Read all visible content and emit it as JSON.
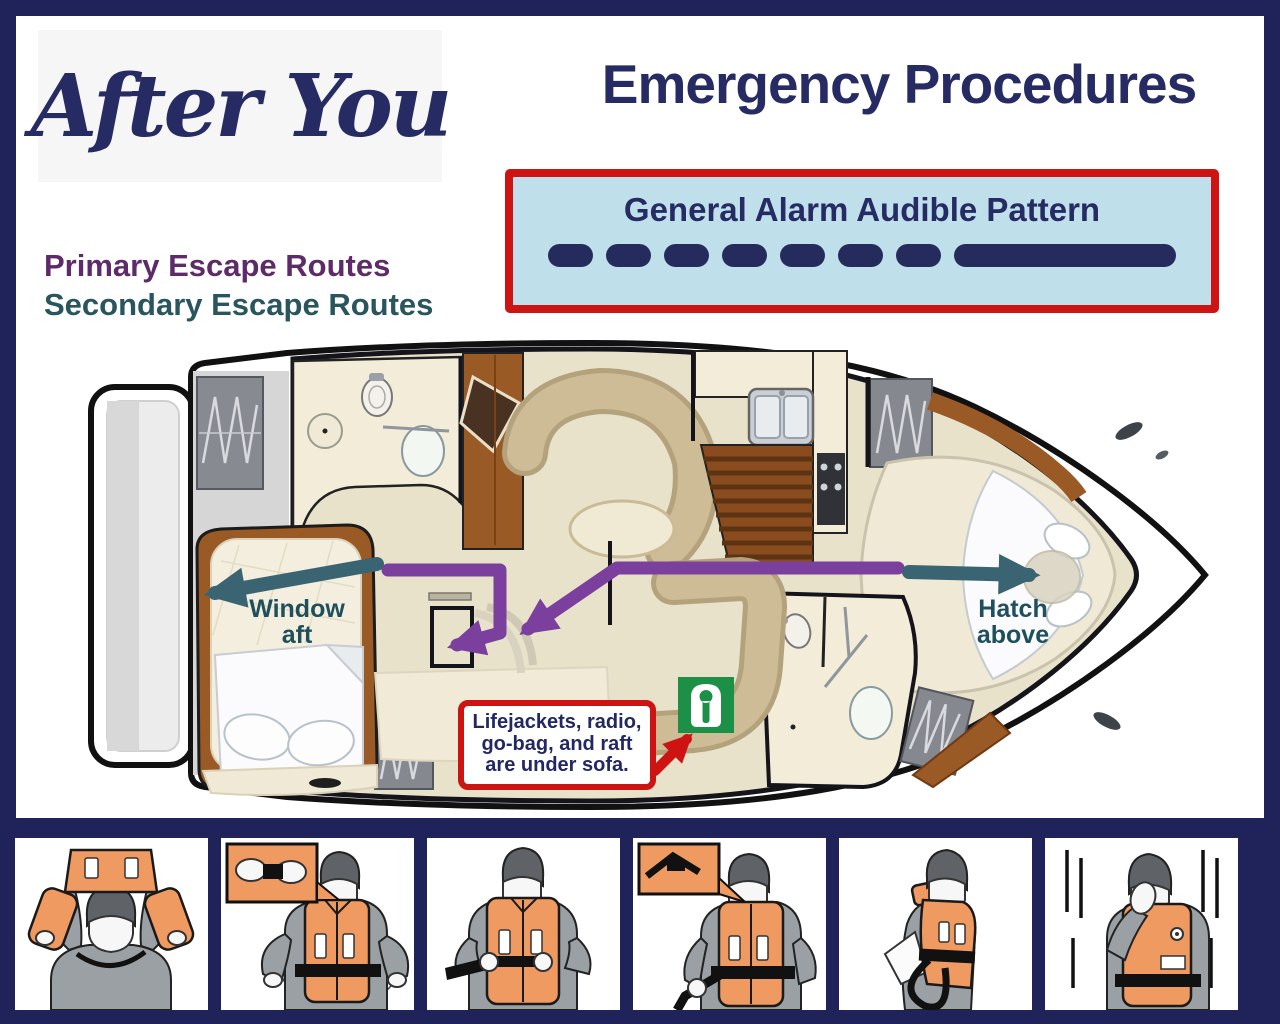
{
  "header": {
    "boat_name": "After You",
    "title": "Emergency Procedures"
  },
  "alarm": {
    "title": "General Alarm Audible Pattern",
    "dashes": [
      "short",
      "short",
      "short",
      "short",
      "short",
      "short",
      "short",
      "long"
    ],
    "pattern_description": "seven short blasts followed by one prolonged blast"
  },
  "legend": {
    "primary_label": "Primary Escape Routes",
    "secondary_label": "Secondary Escape Routes"
  },
  "plan": {
    "window_label_line1": "Window",
    "window_label_line2": "aft",
    "hatch_label_line1": "Hatch",
    "hatch_label_line2": "above",
    "note_line1": "Lifejackets, radio,",
    "note_line2": "go-bag, and raft",
    "note_line3": "are under sofa.",
    "locker_icon": "lifejacket-icon"
  },
  "steps": [
    {
      "name": "lift-lifejacket-over-head"
    },
    {
      "name": "clip-waist-buckle"
    },
    {
      "name": "tighten-waist-strap"
    },
    {
      "name": "secure-strap-end"
    },
    {
      "name": "pass-strap-behind-back"
    },
    {
      "name": "cover-face-before-jumping"
    }
  ],
  "colors": {
    "navy": "#20225a",
    "navy-text": "#262b63",
    "red": "#cd1412",
    "light-blue": "#bfe0ea",
    "purple-label": "#5e2b69",
    "teal-label": "#28555e",
    "purple-arrow": "#7b3f9e",
    "teal-arrow": "#3a6472",
    "note-text": "#232864",
    "green-icon": "#1d9048",
    "vest-orange": "#ef9a60",
    "hull-beige": "#e9e2ca",
    "wood": "#9a5a26"
  }
}
